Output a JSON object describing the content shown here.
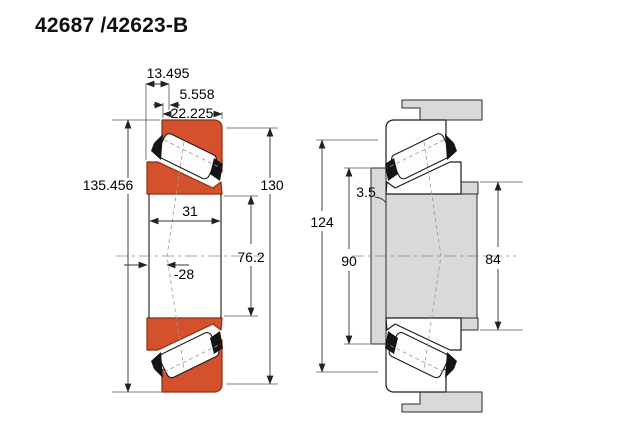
{
  "title": "42687 /42623-B",
  "views": {
    "left": {
      "label": "bearing cross-section",
      "dims": {
        "stand_out": "13.495",
        "flange_width": "5.558",
        "cup_width": "22.225",
        "flange_od": "135.456",
        "outer_dia": "130",
        "inner_width": "31",
        "bore_dia": "76.2",
        "load_center_offset": "-28"
      }
    },
    "right": {
      "label": "mounted arrangement cross-section",
      "dims": {
        "housing_abutment_dia": "124",
        "shaft_shoulder_dia": "90",
        "shaft_abutment_dia": "84",
        "fillet_radius": "3.5"
      }
    }
  },
  "colors": {
    "ring_fill": "#d4512d",
    "ring_stroke": "#8c2c12",
    "steel_gray": "#d9d9d9",
    "line": "#1c1c1c"
  }
}
